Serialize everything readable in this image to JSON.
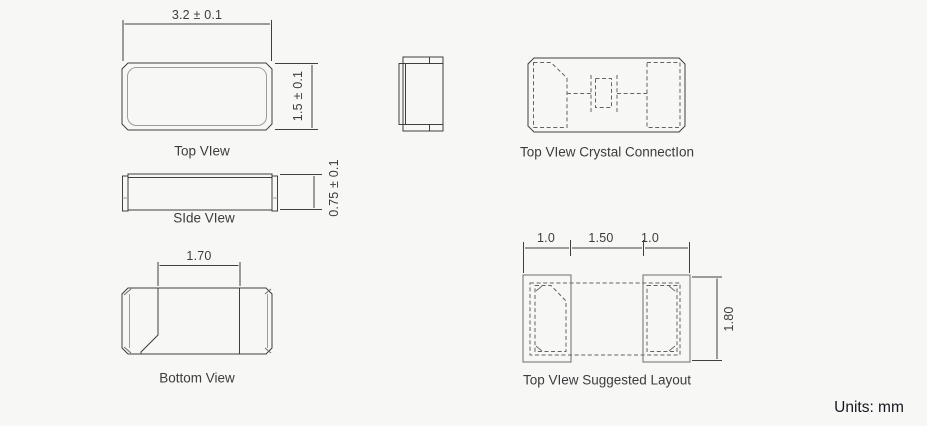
{
  "page": {
    "units_label": "Units: mm"
  },
  "views": {
    "top": {
      "label": "Top VIew",
      "dim_width": "3.2 ± 0.1",
      "dim_height": "1.5 ± 0.1"
    },
    "side": {
      "label": "SIde VIew",
      "dim_height": "0.75 ± 0.1"
    },
    "bottom": {
      "label": "Bottom View",
      "dim_pad_gap": "1.70"
    },
    "crystal_connection": {
      "label": "Top VIew Crystal ConnectIon"
    },
    "suggested_layout": {
      "label": "Top VIew Suggested Layout",
      "dim_left_pad_width": "1.0",
      "dim_pad_gap": "1.50",
      "dim_right_pad_width": "1.0",
      "dim_height": "1.80"
    }
  }
}
